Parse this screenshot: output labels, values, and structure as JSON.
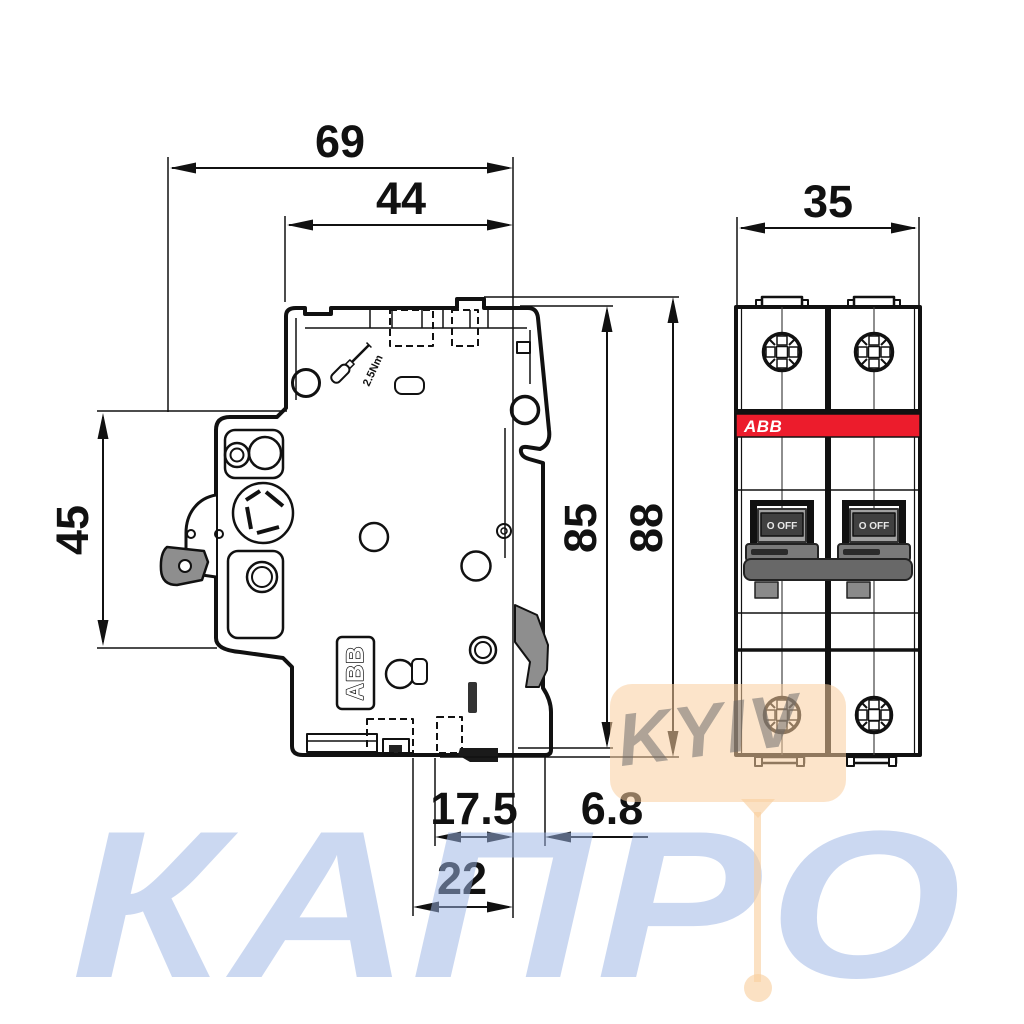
{
  "title": "ABB modular circuit breaker dimension drawing (side and front views)",
  "dims": {
    "total_width": "69",
    "body_width": "44",
    "module_width": "35",
    "latch_height": "45",
    "body_height": "85",
    "total_height": "88",
    "din_offset": "17.5",
    "din_depth": "6.8",
    "din_width": "22"
  },
  "labels": {
    "brand_side": "ABB",
    "brand_front": "ABB",
    "torque": "2.5Nm",
    "switch_state": "O OFF"
  },
  "watermarks": {
    "primary": "КАПРО",
    "secondary": "KYIV"
  },
  "colors": {
    "brand_red": "#ec1c2c",
    "line": "#111111",
    "watermark_blue": "#9bb5e5",
    "watermark_orange": "#f9ce9e",
    "watermark_gray": "#686868",
    "part_gray": "#8e8e8e"
  }
}
